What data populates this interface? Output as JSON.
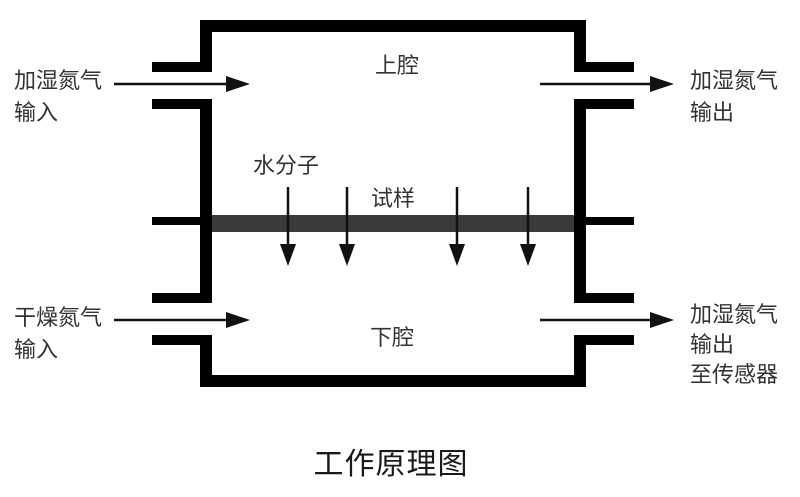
{
  "title": "工作原理图",
  "chamber": {
    "upper_label": "上腔",
    "lower_label": "下腔",
    "sample_label": "试样",
    "water_label": "水分子"
  },
  "ports": {
    "top_left": {
      "line1": "加湿氮气",
      "line2": "输入"
    },
    "top_right": {
      "line1": "加湿氮气",
      "line2": "输出"
    },
    "bottom_left": {
      "line1": "干燥氮气",
      "line2": "输入"
    },
    "bottom_right": {
      "line1": "加湿氮气",
      "line2": "输出",
      "line3": "至传感器"
    }
  },
  "colors": {
    "wall": "#000000",
    "sample": "#3a3a3a",
    "arrow": "#111111",
    "text": "#333333"
  }
}
